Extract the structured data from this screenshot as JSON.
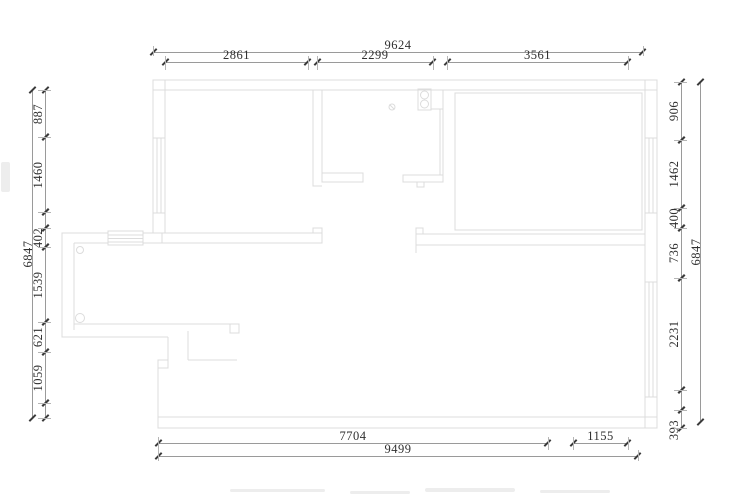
{
  "drawing": {
    "type": "floor-plan",
    "colors": {
      "background": "#ffffff",
      "plan_line": "#dcdcdc",
      "dimension_line": "#9a9a9a",
      "tick": "#3a3a3a",
      "text": "#2f2f2f"
    }
  },
  "dims": {
    "top": {
      "total": "9624",
      "segments": [
        "2861",
        "2299",
        "3561"
      ]
    },
    "bottom": {
      "total": "9499",
      "segments": [
        "7704",
        "1155"
      ]
    },
    "left": {
      "total": "6847",
      "segments": [
        "887",
        "1460",
        "402",
        "1539",
        "621",
        "1059"
      ]
    },
    "right": {
      "total": "6847",
      "segments": [
        "906",
        "1462",
        "400",
        "736",
        "2231",
        "393"
      ]
    }
  }
}
